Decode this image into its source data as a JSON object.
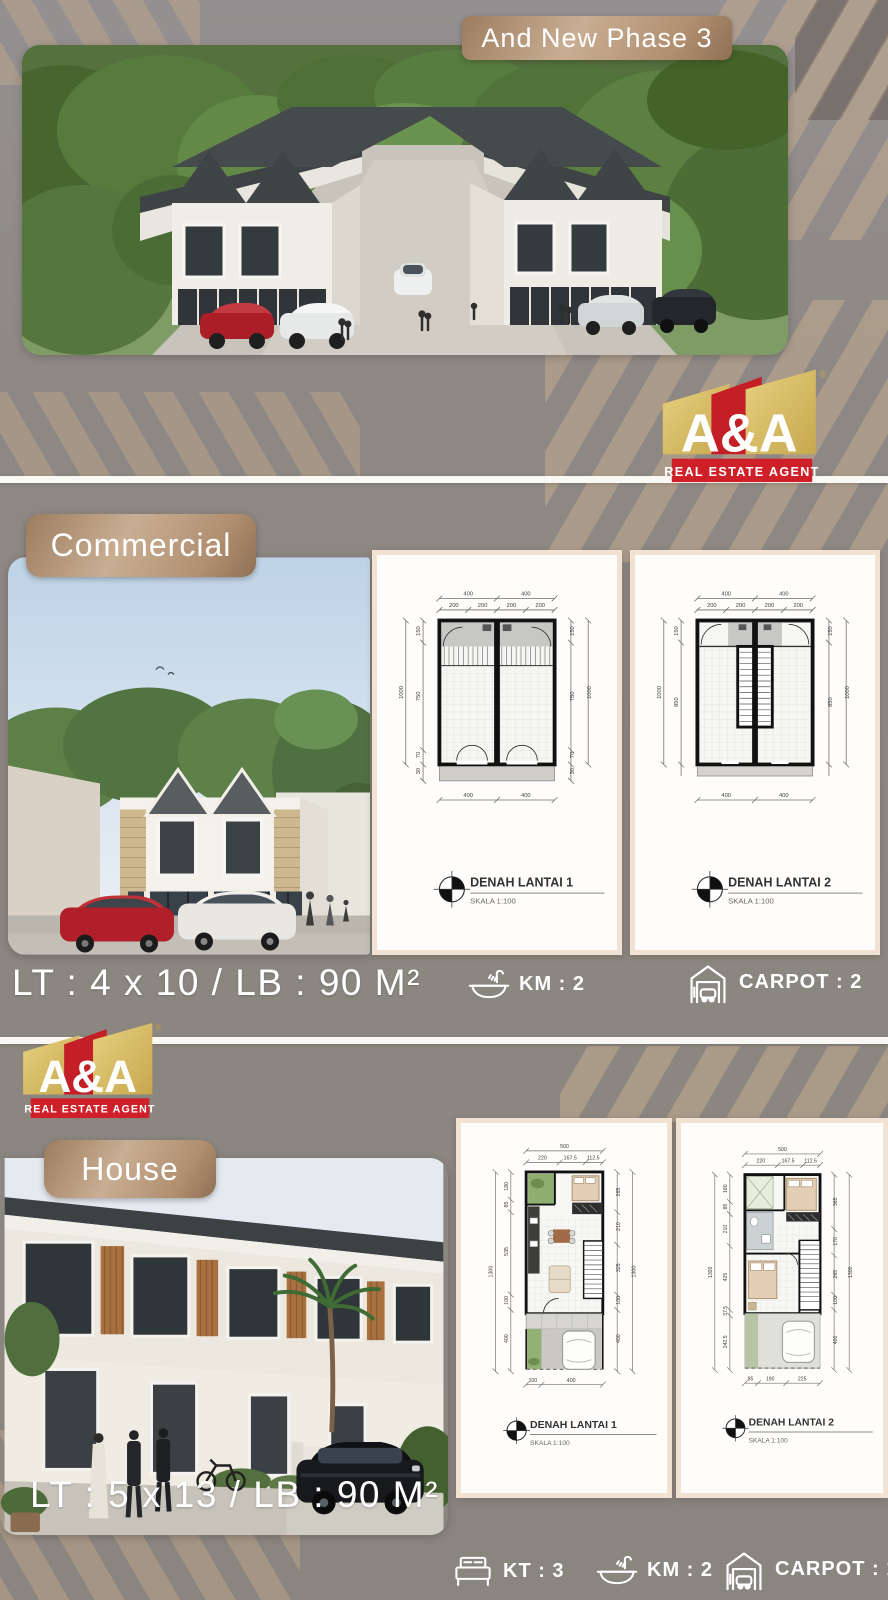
{
  "page": {
    "bg_color": "#8e8883",
    "accent_bronze": "#b59478",
    "stripe_tan": "#c2a88a",
    "logo_gold": "#d9bd62",
    "logo_red": "#cf1f27"
  },
  "hero": {
    "badge": "And New Phase 3"
  },
  "logo": {
    "brand": "A&A",
    "tagline": "REAL ESTATE AGENT",
    "registered": "®"
  },
  "commercial": {
    "label": "Commercial",
    "specs": "LT : 4 x 10 / LB : 90 M²",
    "features": [
      {
        "icon": "bath-icon",
        "label": "KM : 2"
      },
      {
        "icon": "garage-icon",
        "label": "CARPOT : 2"
      }
    ],
    "plans": [
      {
        "title": "DENAH LANTAI 1",
        "scale": "SKALA  1:100",
        "dims": {
          "top_major": [
            "400",
            "400"
          ],
          "top_minor": [
            "200",
            "200",
            "200",
            "200"
          ],
          "left": [
            "150",
            "750",
            "70",
            "30"
          ],
          "left_total": "1000",
          "right": [
            "150",
            "750",
            "70",
            "30"
          ],
          "right_total": "1000",
          "bottom": [
            "400",
            "400"
          ]
        }
      },
      {
        "title": "DENAH LANTAI 2",
        "scale": "SKALA  1:100",
        "dims": {
          "top_major": [
            "400",
            "400"
          ],
          "top_minor": [
            "200",
            "200",
            "200",
            "200"
          ],
          "left": [
            "150",
            "850"
          ],
          "left_total": "1000",
          "right": [
            "150",
            "850"
          ],
          "right_total": "1000",
          "bottom": [
            "400",
            "400"
          ]
        }
      }
    ]
  },
  "house": {
    "label": "House",
    "specs": "LT : 5 x 13 / LB : 90 M²",
    "features": [
      {
        "icon": "bed-icon",
        "label": "KT : 3"
      },
      {
        "icon": "bath-icon",
        "label": "KM : 2"
      },
      {
        "icon": "garage-icon",
        "label": "CARPOT : 1"
      }
    ],
    "plans": [
      {
        "title": "DENAH LANTAI 1",
        "scale": "SKALA  1:100",
        "dims": {
          "top_major": [
            "500"
          ],
          "top_minor": [
            "220",
            "167.5",
            "112.5"
          ],
          "left": [
            "180",
            "85",
            "535",
            "100",
            "400"
          ],
          "left_total": "1300",
          "right": [
            "265",
            "210",
            "325",
            "100",
            "400"
          ],
          "right_total": "1300",
          "bottom": [
            "100",
            "400"
          ]
        }
      },
      {
        "title": "DENAH LANTAI 2",
        "scale": "SKALA  1:100",
        "dims": {
          "top_major": [
            "500"
          ],
          "top_minor": [
            "220",
            "167.5",
            "112.5"
          ],
          "left": [
            "180",
            "85",
            "210",
            "425",
            "37.5",
            "242.5"
          ],
          "left_total": "1300",
          "right": [
            "365",
            "170",
            "265",
            "100",
            "400"
          ],
          "right_total": "1300",
          "bottom": [
            "85",
            "190",
            "225"
          ]
        }
      }
    ]
  }
}
